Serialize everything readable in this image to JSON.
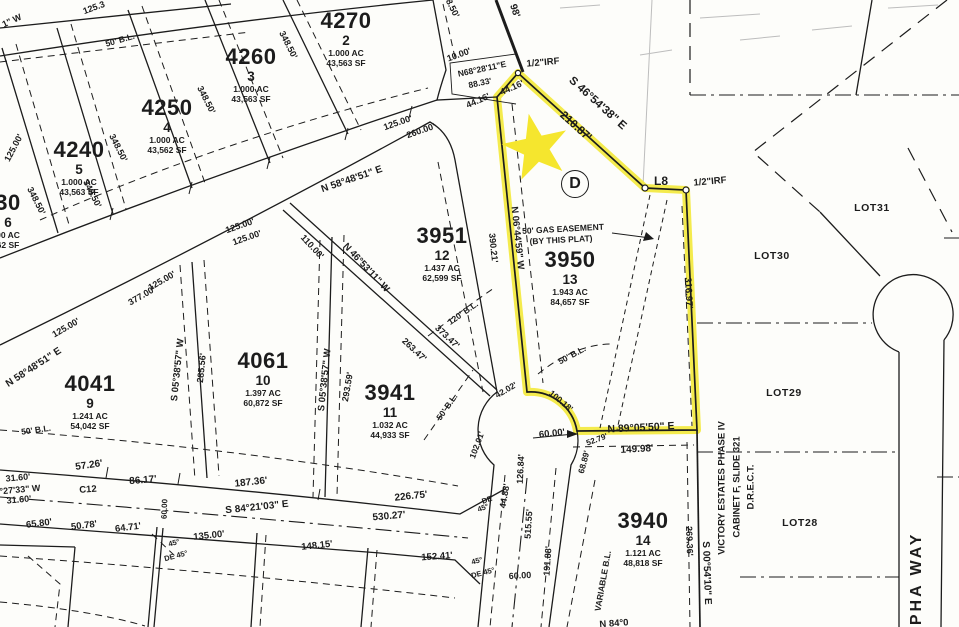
{
  "map": {
    "colors": {
      "ink": "#1c1c1c",
      "paper": "#fdfdfa",
      "highlight": "#f3e93e",
      "star": "#f5e62e"
    },
    "markers": {
      "circled_d": {
        "letter": "D"
      }
    },
    "lots": [
      {
        "block": "4270",
        "lot": "2",
        "ac": "1.000 AC",
        "sf": "43,563 SF",
        "x": 346,
        "y": 10
      },
      {
        "block": "4260",
        "lot": "3",
        "ac": "1.000 AC",
        "sf": "43,563 SF",
        "x": 251,
        "y": 46
      },
      {
        "block": "4250",
        "lot": "4",
        "ac": "1.000 AC",
        "sf": "43,562 SF",
        "x": 167,
        "y": 97
      },
      {
        "block": "4240",
        "lot": "5",
        "ac": "1.000 AC",
        "sf": "43,563 SF",
        "x": 79,
        "y": 139
      },
      {
        "block": "30",
        "lot": "6",
        "ac": "00 AC",
        "sf": "62 SF",
        "x": 8,
        "y": 192
      },
      {
        "block": "3951",
        "lot": "12",
        "ac": "1.437 AC",
        "sf": "62,599 SF",
        "x": 442,
        "y": 225
      },
      {
        "block": "3950",
        "lot": "13",
        "ac": "1.943 AC",
        "sf": "84,657 SF",
        "x": 570,
        "y": 249
      },
      {
        "block": "4041",
        "lot": "9",
        "ac": "1.241 AC",
        "sf": "54,042 SF",
        "x": 90,
        "y": 373
      },
      {
        "block": "4061",
        "lot": "10",
        "ac": "1.397 AC",
        "sf": "60,872 SF",
        "x": 263,
        "y": 350
      },
      {
        "block": "3941",
        "lot": "11",
        "ac": "1.032 AC",
        "sf": "44,933 SF",
        "x": 390,
        "y": 382
      },
      {
        "block": "3940",
        "lot": "14",
        "ac": "1.121 AC",
        "sf": "48,818 SF",
        "x": 643,
        "y": 510
      }
    ],
    "adjacent_lots": [
      {
        "t": "LOT31",
        "x": 872,
        "y": 208
      },
      {
        "t": "LOT30",
        "x": 772,
        "y": 256
      },
      {
        "t": "LOT29",
        "x": 784,
        "y": 393
      },
      {
        "t": "LOT28",
        "x": 800,
        "y": 523
      }
    ],
    "labels": [
      {
        "t": "125.3",
        "x": 94,
        "y": 8,
        "r": -20,
        "s": 9
      },
      {
        "t": "1\" W",
        "x": 12,
        "y": 21,
        "r": -25,
        "s": 9
      },
      {
        "t": "125.00'",
        "x": 14,
        "y": 148,
        "r": -62,
        "s": 9
      },
      {
        "t": "50' B.L.",
        "x": 120,
        "y": 40,
        "r": -16,
        "s": 8.5
      },
      {
        "t": "348.50'",
        "x": 450,
        "y": 4,
        "r": 63,
        "s": 9
      },
      {
        "t": "348.50'",
        "x": 288,
        "y": 45,
        "r": 63,
        "s": 9
      },
      {
        "t": "348.50'",
        "x": 206,
        "y": 100,
        "r": 63,
        "s": 9
      },
      {
        "t": "348.50'",
        "x": 118,
        "y": 148,
        "r": 63,
        "s": 9
      },
      {
        "t": "348.50'",
        "x": 92,
        "y": 194,
        "r": 63,
        "s": 9
      },
      {
        "t": "348.50'",
        "x": 36,
        "y": 201,
        "r": 63,
        "s": 9
      },
      {
        "t": "N 58°48'51\" E",
        "x": 352,
        "y": 180,
        "r": -19,
        "s": 10
      },
      {
        "t": "125.00'",
        "x": 398,
        "y": 123,
        "r": -19,
        "s": 9
      },
      {
        "t": "260.00'",
        "x": 421,
        "y": 131,
        "r": -19,
        "s": 9
      },
      {
        "t": "125.00'",
        "x": 240,
        "y": 226,
        "r": -19,
        "s": 9
      },
      {
        "t": "125.00'",
        "x": 247,
        "y": 238,
        "r": -19,
        "s": 9
      },
      {
        "t": "125.00'",
        "x": 162,
        "y": 281,
        "r": -30,
        "s": 9
      },
      {
        "t": "377.00'",
        "x": 142,
        "y": 296,
        "r": -30,
        "s": 9
      },
      {
        "t": "125.00'",
        "x": 66,
        "y": 328,
        "r": -30,
        "s": 9
      },
      {
        "t": "N 58°48'51\" E",
        "x": 34,
        "y": 368,
        "r": -33,
        "s": 10
      },
      {
        "t": "110.00'",
        "x": 312,
        "y": 247,
        "r": 47,
        "s": 9
      },
      {
        "t": "N 46°53'11\" W",
        "x": 366,
        "y": 268,
        "r": 47,
        "s": 9.5
      },
      {
        "t": "S 05°38'57\" W",
        "x": 178,
        "y": 370,
        "r": -84,
        "s": 9.5
      },
      {
        "t": "285.56'",
        "x": 202,
        "y": 368,
        "r": -84,
        "s": 9
      },
      {
        "t": "S 05°38'57\" W",
        "x": 325,
        "y": 380,
        "r": -84,
        "s": 9.5
      },
      {
        "t": "293.59'",
        "x": 348,
        "y": 387,
        "r": -80,
        "s": 9
      },
      {
        "t": "263.47'",
        "x": 414,
        "y": 350,
        "r": 43,
        "s": 9
      },
      {
        "t": "373.47'",
        "x": 447,
        "y": 337,
        "r": 43,
        "s": 9
      },
      {
        "t": "120' B.L.",
        "x": 463,
        "y": 313,
        "r": -35,
        "s": 8.5
      },
      {
        "t": "50' B.L.",
        "x": 447,
        "y": 407,
        "r": -55,
        "s": 8.5
      },
      {
        "t": "50' B.L.",
        "x": 572,
        "y": 355,
        "r": -28,
        "s": 8.5
      },
      {
        "t": "50' B.L.",
        "x": 36,
        "y": 430,
        "r": -8,
        "s": 8.5
      },
      {
        "t": "N 06°44'59\" W",
        "x": 517,
        "y": 238,
        "r": 84,
        "s": 9.5
      },
      {
        "t": "390.21'",
        "x": 493,
        "y": 248,
        "r": 84,
        "s": 9
      },
      {
        "t": "98'",
        "x": 514,
        "y": 11,
        "r": 72,
        "s": 10
      },
      {
        "t": "10.00'",
        "x": 459,
        "y": 55,
        "r": -20,
        "s": 9
      },
      {
        "t": "N68°28'11\"E",
        "x": 482,
        "y": 69,
        "r": -12,
        "s": 8.5
      },
      {
        "t": "88.33'",
        "x": 480,
        "y": 83,
        "r": -12,
        "s": 8.5
      },
      {
        "t": "44.16'",
        "x": 478,
        "y": 101,
        "r": -24,
        "s": 9
      },
      {
        "t": "44.16'",
        "x": 512,
        "y": 88,
        "r": -24,
        "s": 9
      },
      {
        "t": "1/2\"IRF",
        "x": 543,
        "y": 63,
        "r": -5,
        "s": 9.5
      },
      {
        "t": "S 46°54'38\" E",
        "x": 597,
        "y": 104,
        "r": 42,
        "s": 11.5
      },
      {
        "t": "210.87'",
        "x": 575,
        "y": 127,
        "r": 42,
        "s": 11.5
      },
      {
        "t": "L8",
        "x": 661,
        "y": 181,
        "r": 0,
        "s": 12
      },
      {
        "t": "1/2\"IRF",
        "x": 710,
        "y": 182,
        "r": -5,
        "s": 9.5
      },
      {
        "t": "50' GAS EASEMENT",
        "x": 563,
        "y": 229,
        "r": -3,
        "s": 8.5
      },
      {
        "t": "(BY THIS PLAT)",
        "x": 561,
        "y": 240,
        "r": -3,
        "s": 8.5
      },
      {
        "t": "316.97'",
        "x": 688,
        "y": 293,
        "r": 87,
        "s": 9.5
      },
      {
        "t": "N 89°05'50\" E",
        "x": 641,
        "y": 428,
        "r": -3,
        "s": 10.5
      },
      {
        "t": "149.98'",
        "x": 637,
        "y": 450,
        "r": -3,
        "s": 10
      },
      {
        "t": "52.79'",
        "x": 597,
        "y": 440,
        "r": -20,
        "s": 8
      },
      {
        "t": "60.00'",
        "x": 552,
        "y": 434,
        "r": -6,
        "s": 9.5
      },
      {
        "t": "126.84'",
        "x": 521,
        "y": 469,
        "r": -87,
        "s": 9
      },
      {
        "t": "44.88'",
        "x": 505,
        "y": 496,
        "r": -80,
        "s": 9
      },
      {
        "t": "102.01'",
        "x": 477,
        "y": 445,
        "r": -70,
        "s": 8.5
      },
      {
        "t": "42.02'",
        "x": 506,
        "y": 390,
        "r": -30,
        "s": 8.5
      },
      {
        "t": "100.18'",
        "x": 561,
        "y": 401,
        "r": 40,
        "s": 8.5
      },
      {
        "t": "68.89'",
        "x": 584,
        "y": 462,
        "r": -75,
        "s": 8.5
      },
      {
        "t": "515.55'",
        "x": 529,
        "y": 524,
        "r": -86,
        "s": 9
      },
      {
        "t": "191.88'",
        "x": 548,
        "y": 561,
        "r": -86,
        "s": 9
      },
      {
        "t": "60.00",
        "x": 520,
        "y": 576,
        "r": -3,
        "s": 9
      },
      {
        "t": "DE",
        "x": 487,
        "y": 500,
        "r": -20,
        "s": 7.5
      },
      {
        "t": "45°",
        "x": 483,
        "y": 508,
        "r": -20,
        "s": 7.5
      },
      {
        "t": "45°",
        "x": 477,
        "y": 561,
        "r": -15,
        "s": 7.5
      },
      {
        "t": "DE 45°",
        "x": 483,
        "y": 573,
        "r": -15,
        "s": 7.5
      },
      {
        "t": "45°",
        "x": 174,
        "y": 543,
        "r": -15,
        "s": 7.5
      },
      {
        "t": "DE 45°",
        "x": 176,
        "y": 556,
        "r": -15,
        "s": 7.5
      },
      {
        "t": "VARIABLE B.L.",
        "x": 603,
        "y": 581,
        "r": -80,
        "s": 8.5
      },
      {
        "t": "N 84°0",
        "x": 614,
        "y": 624,
        "r": -4,
        "s": 9.5
      },
      {
        "t": "57.26'",
        "x": 89,
        "y": 466,
        "r": -8,
        "s": 10
      },
      {
        "t": "86.17'",
        "x": 143,
        "y": 481,
        "r": -5,
        "s": 10
      },
      {
        "t": "187.36'",
        "x": 251,
        "y": 483,
        "r": -6,
        "s": 10
      },
      {
        "t": "226.75'",
        "x": 411,
        "y": 497,
        "r": -6,
        "s": 10
      },
      {
        "t": "S 84°21'03\" E",
        "x": 257,
        "y": 508,
        "r": -6,
        "s": 10
      },
      {
        "t": "530.27'",
        "x": 389,
        "y": 517,
        "r": -5,
        "s": 10
      },
      {
        "t": "C12",
        "x": 88,
        "y": 490,
        "r": -4,
        "s": 9.5
      },
      {
        "t": "31.60'",
        "x": 18,
        "y": 478,
        "r": -5,
        "s": 9
      },
      {
        "t": "°27'33\" W",
        "x": 20,
        "y": 490,
        "r": -5,
        "s": 9
      },
      {
        "t": "31.60'",
        "x": 19,
        "y": 500,
        "r": -5,
        "s": 9
      },
      {
        "t": "65.80'",
        "x": 39,
        "y": 524,
        "r": -7,
        "s": 9.5
      },
      {
        "t": "50.78'",
        "x": 84,
        "y": 526,
        "r": -7,
        "s": 9.5
      },
      {
        "t": "64.71'",
        "x": 128,
        "y": 528,
        "r": -7,
        "s": 9.5
      },
      {
        "t": "135.00'",
        "x": 209,
        "y": 536,
        "r": -6,
        "s": 9.5
      },
      {
        "t": "148.15'",
        "x": 317,
        "y": 546,
        "r": -6,
        "s": 9.5
      },
      {
        "t": "152.41'",
        "x": 437,
        "y": 557,
        "r": -4,
        "s": 9.5
      },
      {
        "t": "60.00",
        "x": 165,
        "y": 509,
        "r": -88,
        "s": 8
      },
      {
        "t": "S 00°54'10\" E",
        "x": 706,
        "y": 573,
        "r": 88,
        "s": 10
      },
      {
        "t": "269.36'",
        "x": 689,
        "y": 541,
        "r": 88,
        "s": 9
      },
      {
        "t": "VICTORY ESTATES PHASE IV",
        "x": 722,
        "y": 488,
        "r": -90,
        "s": 9.5
      },
      {
        "t": "CABINET F, SLIDE 321",
        "x": 737,
        "y": 487,
        "r": -90,
        "s": 9.5
      },
      {
        "t": "D.R.E.C.T.",
        "x": 751,
        "y": 487,
        "r": -90,
        "s": 9.5
      },
      {
        "t": "ALPHA WAY",
        "x": 917,
        "y": 592,
        "r": -90,
        "s": 16,
        "ls": 3
      }
    ]
  }
}
